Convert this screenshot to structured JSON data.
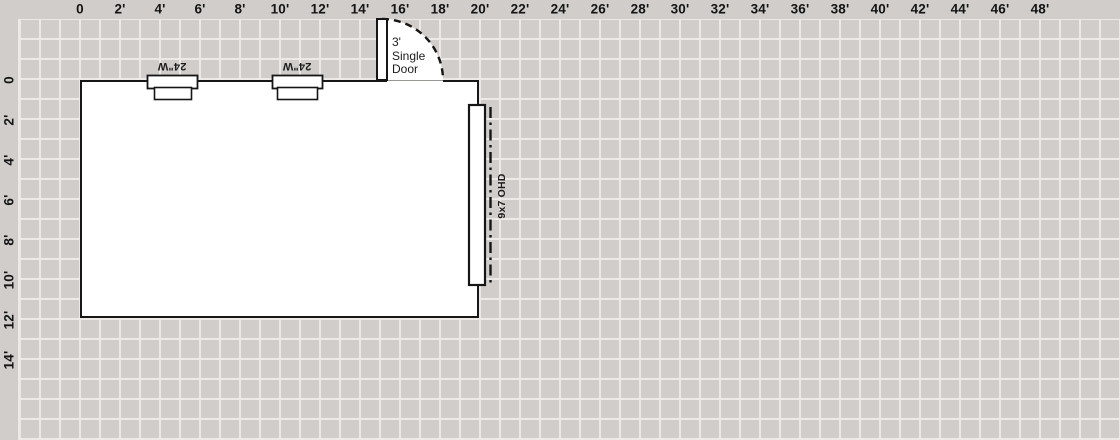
{
  "canvas": {
    "background_color": "#d0cdca",
    "grid_line_color": "#ece9e6",
    "wall_color": "#161616",
    "grid_cell_feet": 1,
    "grid_cell_px": 20
  },
  "rulers": {
    "top": {
      "labels": [
        "0",
        "2'",
        "4'",
        "6'",
        "8'",
        "10'",
        "12'",
        "14'",
        "16'",
        "18'",
        "20'",
        "22'",
        "24'",
        "26'",
        "28'",
        "30'",
        "32'",
        "34'",
        "36'",
        "38'",
        "40'",
        "42'",
        "44'",
        "46'",
        "48'"
      ]
    },
    "left": {
      "labels": [
        "0",
        "2'",
        "4'",
        "6'",
        "8'",
        "10'",
        "12'",
        "14'"
      ]
    }
  },
  "floor_plan": {
    "room": {
      "width_feet": 20,
      "height_feet": 12
    },
    "door": {
      "label": "3'\nSingle\nDoor"
    },
    "windows": [
      {
        "label": "24\"W"
      },
      {
        "label": "24\"W"
      }
    ],
    "ohd": {
      "label": "9x7 OHD"
    }
  }
}
